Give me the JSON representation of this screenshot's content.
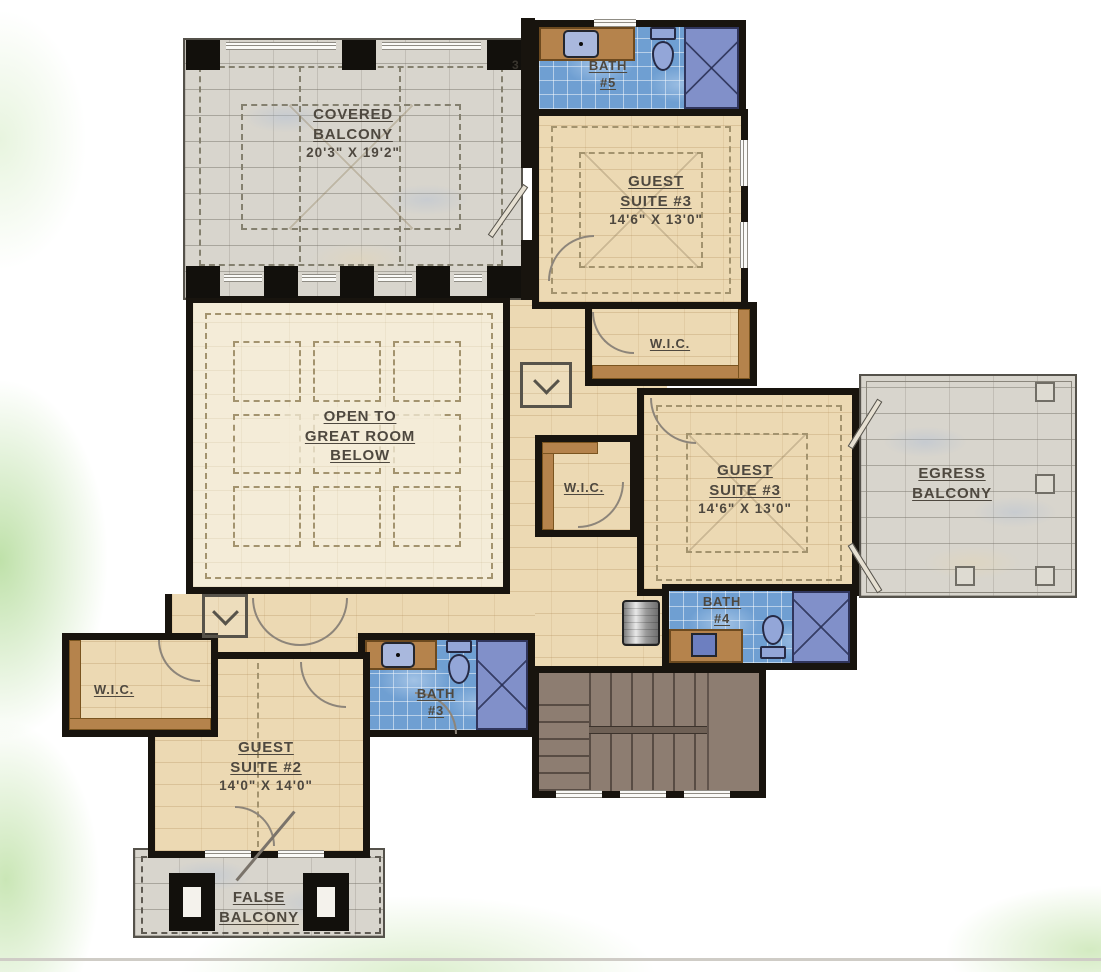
{
  "floor_plan": {
    "marker_note": "3",
    "rooms": {
      "covered_balcony": {
        "line1": "COVERED",
        "line2": "BALCONY",
        "dims": "20'3\" X 19'2\""
      },
      "bath_5": {
        "line1": "BATH",
        "line2": "#5"
      },
      "guest_suite_3_upper": {
        "line1": "GUEST",
        "line2": "SUITE #3",
        "dims": "14'6\" X 13'0\""
      },
      "wic_upper": {
        "label": "W.I.C."
      },
      "open_to_great_room": {
        "line1": "OPEN TO",
        "line2": "GREAT ROOM",
        "line3": "BELOW"
      },
      "wic_middle": {
        "label": "W.I.C."
      },
      "guest_suite_3_right": {
        "line1": "GUEST",
        "line2": "SUITE #3",
        "dims": "14'6\" X 13'0\""
      },
      "egress_balcony": {
        "line1": "EGRESS",
        "line2": "BALCONY"
      },
      "bath_4": {
        "line1": "BATH",
        "line2": "#4"
      },
      "bath_3": {
        "line1": "BATH",
        "line2": "#3"
      },
      "wic_lower": {
        "label": "W.I.C."
      },
      "guest_suite_2": {
        "line1": "GUEST",
        "line2": "SUITE #2",
        "dims": "14'0\" X 14'0\""
      },
      "false_balcony": {
        "line1": "FALSE",
        "line2": "BALCONY"
      }
    },
    "colors": {
      "wall": "#18140e",
      "wood_floor": "#ecd9b3",
      "great_room_floor": "#f4ecd8",
      "stone_tile": "#d8d5cd",
      "bath_tile": "#6f9fd2",
      "shower": "#8190c9",
      "cabinet": "#b5834c",
      "stairs": "#8d7d71",
      "label_text": "#4e483f",
      "accent_green": "#a8d588"
    }
  }
}
